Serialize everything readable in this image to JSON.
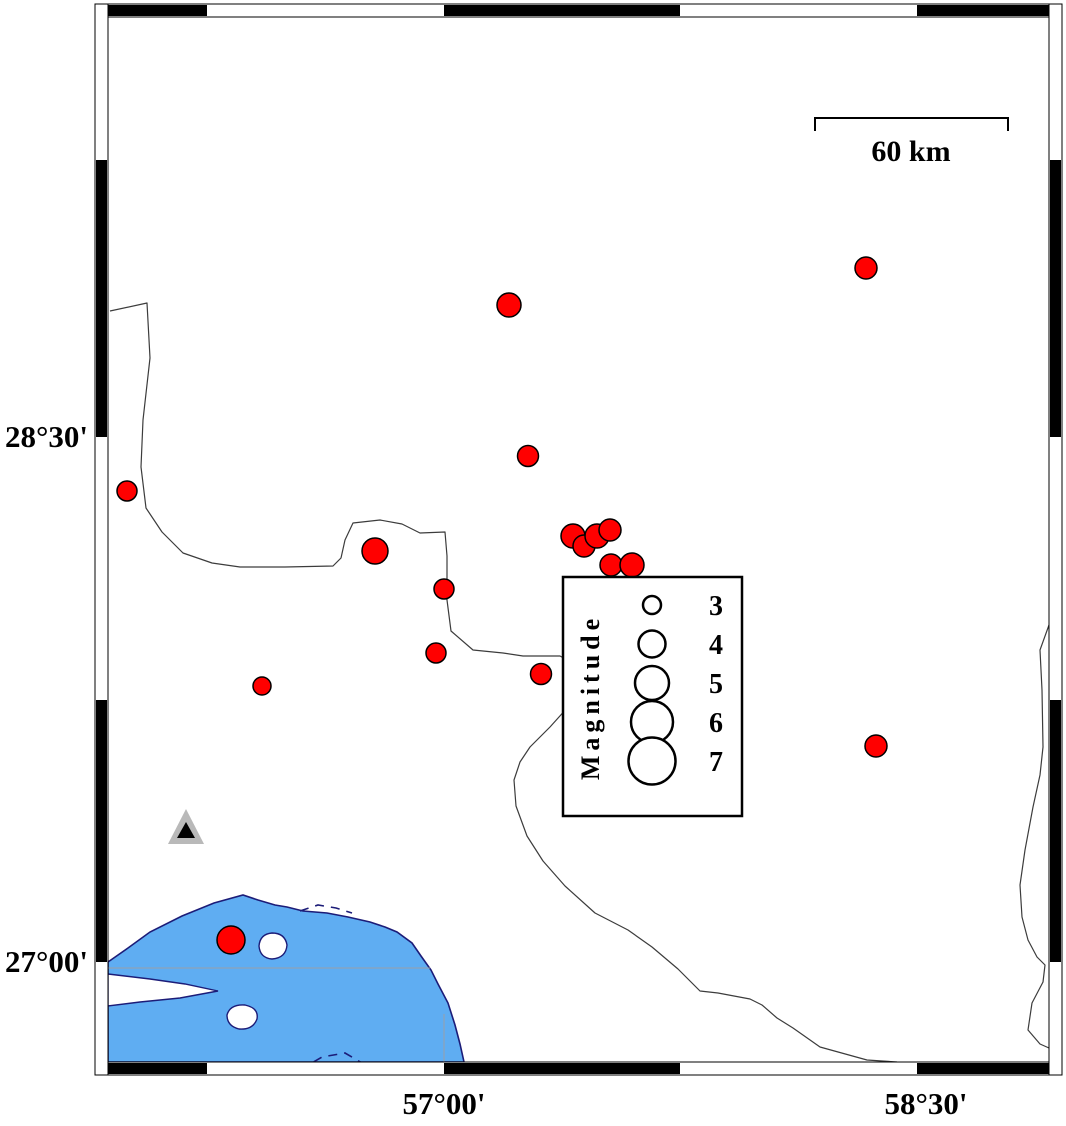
{
  "axis_labels": {
    "left": [
      {
        "text": "28°30'",
        "x": 88,
        "y": 447
      },
      {
        "text": "27°00'",
        "x": 88,
        "y": 972
      }
    ],
    "bottom": [
      {
        "text": "57°00'",
        "x": 444,
        "y": 1114
      },
      {
        "text": "58°30'",
        "x": 926,
        "y": 1114
      }
    ]
  },
  "scale_bar": {
    "label": "60 km",
    "x1": 815,
    "x2": 1008,
    "y": 118,
    "tick_drop": 13,
    "label_x": 911,
    "label_y": 161
  },
  "legend": {
    "title": "Magnitude",
    "box": {
      "x": 563,
      "y": 577,
      "width": 179,
      "height": 239
    },
    "title_x": 599,
    "title_y": 697,
    "circle_x": 652,
    "value_x": 716,
    "items": [
      {
        "value": "3",
        "r": 9,
        "y": 605
      },
      {
        "value": "4",
        "r": 13.5,
        "y": 644
      },
      {
        "value": "5",
        "r": 17,
        "y": 683
      },
      {
        "value": "6",
        "r": 21,
        "y": 722
      },
      {
        "value": "7",
        "r": 23.5,
        "y": 761
      }
    ]
  },
  "epicenters": [
    {
      "x": 866,
      "y": 268,
      "r": 11
    },
    {
      "x": 509,
      "y": 305,
      "r": 12
    },
    {
      "x": 528,
      "y": 456,
      "r": 10.5
    },
    {
      "x": 127,
      "y": 491,
      "r": 10
    },
    {
      "x": 375,
      "y": 551,
      "r": 13
    },
    {
      "x": 573,
      "y": 536,
      "r": 12
    },
    {
      "x": 584,
      "y": 546,
      "r": 11
    },
    {
      "x": 597,
      "y": 536,
      "r": 12
    },
    {
      "x": 610,
      "y": 530,
      "r": 11
    },
    {
      "x": 611,
      "y": 565,
      "r": 11
    },
    {
      "x": 632,
      "y": 565,
      "r": 12
    },
    {
      "x": 444,
      "y": 589,
      "r": 10
    },
    {
      "x": 436,
      "y": 653,
      "r": 10
    },
    {
      "x": 541,
      "y": 674,
      "r": 10.5
    },
    {
      "x": 262,
      "y": 686,
      "r": 9
    },
    {
      "x": 876,
      "y": 746,
      "r": 11
    },
    {
      "x": 231,
      "y": 940,
      "r": 14
    }
  ],
  "station": {
    "outer_points": "168,844 204,844 186,809",
    "inner_points": "177,838 195,838 186,822"
  },
  "frame": {
    "outer": {
      "x": 95,
      "y": 4,
      "w": 967,
      "h": 1071
    },
    "band": 13,
    "black_x": [
      [
        108,
        207
      ],
      [
        444,
        680
      ],
      [
        917,
        1049
      ]
    ],
    "black_y": [
      [
        160,
        437
      ],
      [
        700,
        962
      ]
    ]
  },
  "colors": {
    "sea_fill": "#5FADF2",
    "coast_stroke": "#1c1c78",
    "epicenter_fill": "#FF0000",
    "boundary_stroke": "#3c3c3c",
    "station_gray": "#b9b9b9",
    "grid_gray": "#9aa0a8"
  },
  "geo": {
    "sea_path": "M108,962 L128,948 L150,932 L182,916 L214,903 L243,895 L258,900 L275,905 L287,907 L303,911 L327,913 L348,917 L370,922 L385,927 L397,932 L412,943 L421,956 L431,970 L438,984 L448,1003 L455,1025 L460,1044 L464,1062 L108,1062 Z",
    "wedge_path": "M108,974 L150,979 L185,984 L218,991 L180,998 L140,1002 L108,1006 Z",
    "islands": [
      "M259,946 Q260,934 272,933 Q285,933 287,945 Q286,958 272,959 Q260,958 259,946 Z",
      "M227,1015 Q230,1004 245,1005 Q259,1008 257,1019 Q253,1030 239,1029 Q227,1026 227,1015 Z"
    ],
    "dashed_paths": [
      "M300,1070 L322,1057 L345,1053 L362,1063",
      "M300,911 L318,905 L336,908 L352,913"
    ],
    "gridlines": [
      {
        "x1": 108,
        "y1": 968,
        "x2": 430,
        "y2": 968
      },
      {
        "x1": 444,
        "y1": 1014,
        "x2": 444,
        "y2": 1062
      }
    ],
    "boundaries": [
      "M110,311 L147,303 L150,358 L143,420 L141,467 L146,508 L162,532 L183,553 L212,563 L240,567 L285,567 L333,566 L341,558 L345,540 L353,523 L380,520 L402,524 L420,533 L445,532 L447,556 L447,600 L451,631 L473,650 L503,653 L523,656 L560,656 L582,668 L597,688 L588,700 L568,707 L550,727 L530,747 L520,762 L514,780 L516,806 L527,836 L543,861 L565,886 L595,913 L628,930 L652,947 L678,969 L700,991 L718,993 L750,999 L762,1005 L777,1018 L793,1028 L820,1047 L867,1060 L897,1062",
      "M1049,625 L1040,650 L1042,690 L1043,747 L1040,775 L1033,807 L1025,850 L1020,885 L1022,917 L1028,940 L1037,957 L1045,965 L1043,982 L1032,1003 L1028,1030 L1040,1044 L1049,1048"
    ]
  }
}
